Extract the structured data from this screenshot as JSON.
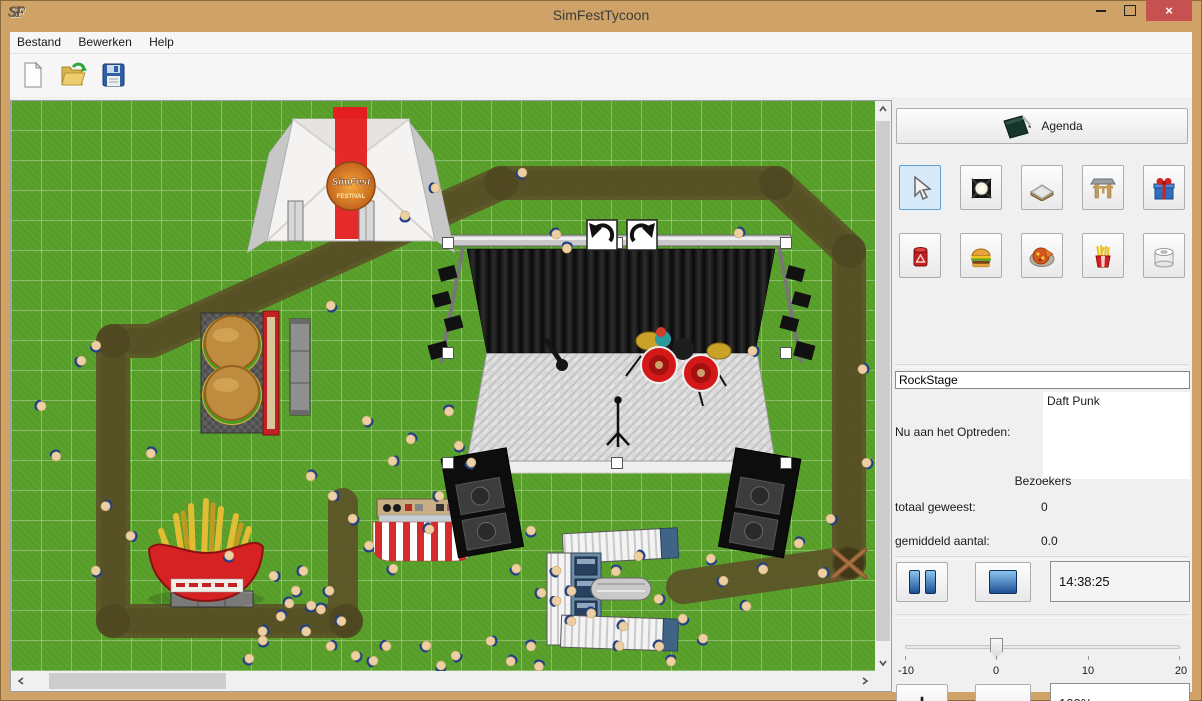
{
  "window": {
    "title": "SimFestTycoon",
    "icon_text": "SF",
    "close_glyph": "×"
  },
  "menu": {
    "items": [
      "Bestand",
      "Bewerken",
      "Help"
    ]
  },
  "toolbar": {
    "buttons": [
      {
        "name": "new-file-button",
        "icon": "new-document-icon"
      },
      {
        "name": "open-file-button",
        "icon": "open-folder-icon"
      },
      {
        "name": "save-file-button",
        "icon": "save-floppy-icon"
      }
    ]
  },
  "panel": {
    "agenda_button": {
      "label": "Agenda",
      "icon": "agenda-book-icon"
    },
    "tools": [
      {
        "name": "select-tool",
        "icon": "cursor-icon",
        "selected": true
      },
      {
        "name": "spotlight-tool",
        "icon": "spotlight-icon",
        "selected": false
      },
      {
        "name": "path-tool",
        "icon": "path-tile-icon",
        "selected": false
      },
      {
        "name": "gate-tool",
        "icon": "entrance-gate-icon",
        "selected": false
      },
      {
        "name": "gift-tool",
        "icon": "gift-icon",
        "selected": false
      },
      {
        "name": "trash-tool",
        "icon": "trash-can-icon",
        "selected": false
      },
      {
        "name": "burger-stand-tool",
        "icon": "hamburger-icon",
        "selected": false
      },
      {
        "name": "pizza-stand-tool",
        "icon": "pizza-icon",
        "selected": false
      },
      {
        "name": "fries-stand-tool",
        "icon": "fries-icon",
        "selected": false
      },
      {
        "name": "toilet-tool",
        "icon": "toilet-roll-icon",
        "selected": false
      }
    ],
    "stage_name_value": "RockStage",
    "now_performing_label": "Nu aan het Optreden:",
    "now_performing_value": "Daft Punk",
    "visitors_header": "Bezoekers",
    "total_visitors_label": "totaal geweest:",
    "total_visitors_value": "0",
    "average_visitors_label": "gemiddeld aantal:",
    "average_visitors_value": "0.0",
    "time_value": "14:38:25",
    "slider": {
      "value": 0,
      "min": -10,
      "max": 20,
      "tick_labels": [
        "-10",
        "0",
        "10",
        "20"
      ]
    },
    "plus_label": "+",
    "minus_label": "−",
    "zoom_value": "100%"
  },
  "map": {
    "stage_selected": true,
    "visitors": [
      [
        394,
        115
      ],
      [
        511,
        72
      ],
      [
        424,
        87
      ],
      [
        545,
        133
      ],
      [
        556,
        147
      ],
      [
        728,
        132
      ],
      [
        742,
        250
      ],
      [
        320,
        205
      ],
      [
        85,
        245
      ],
      [
        70,
        260
      ],
      [
        30,
        305
      ],
      [
        45,
        355
      ],
      [
        140,
        352
      ],
      [
        852,
        268
      ],
      [
        856,
        362
      ],
      [
        448,
        345
      ],
      [
        460,
        362
      ],
      [
        428,
        395
      ],
      [
        418,
        428
      ],
      [
        438,
        310
      ],
      [
        400,
        338
      ],
      [
        382,
        360
      ],
      [
        356,
        320
      ],
      [
        520,
        430
      ],
      [
        545,
        470
      ],
      [
        560,
        490
      ],
      [
        580,
        512
      ],
      [
        605,
        470
      ],
      [
        628,
        455
      ],
      [
        648,
        498
      ],
      [
        672,
        518
      ],
      [
        692,
        538
      ],
      [
        712,
        480
      ],
      [
        735,
        505
      ],
      [
        752,
        468
      ],
      [
        788,
        442
      ],
      [
        812,
        472
      ],
      [
        820,
        418
      ],
      [
        700,
        458
      ],
      [
        505,
        468
      ],
      [
        530,
        492
      ],
      [
        612,
        525
      ],
      [
        660,
        560
      ],
      [
        300,
        375
      ],
      [
        322,
        395
      ],
      [
        342,
        418
      ],
      [
        358,
        445
      ],
      [
        382,
        468
      ],
      [
        292,
        470
      ],
      [
        278,
        502
      ],
      [
        310,
        508
      ],
      [
        252,
        530
      ],
      [
        263,
        475
      ],
      [
        285,
        490
      ],
      [
        300,
        505
      ],
      [
        318,
        490
      ],
      [
        330,
        520
      ],
      [
        295,
        530
      ],
      [
        270,
        515
      ],
      [
        320,
        545
      ],
      [
        345,
        555
      ],
      [
        252,
        540
      ],
      [
        238,
        558
      ],
      [
        545,
        500
      ],
      [
        560,
        520
      ],
      [
        520,
        545
      ],
      [
        500,
        560
      ],
      [
        480,
        540
      ],
      [
        445,
        555
      ],
      [
        430,
        565
      ],
      [
        415,
        545
      ],
      [
        608,
        545
      ],
      [
        648,
        545
      ],
      [
        528,
        565
      ],
      [
        95,
        405
      ],
      [
        120,
        435
      ],
      [
        85,
        470
      ],
      [
        218,
        455
      ],
      [
        362,
        560
      ],
      [
        375,
        545
      ]
    ]
  },
  "colors": {
    "titlebar": "#cfa267",
    "close_button": "#c75050",
    "grass": "#5ba22d",
    "path": "#5c5328",
    "selected_tool_bg": "#d6e9f9",
    "accent_blue": "#1d4f94"
  }
}
